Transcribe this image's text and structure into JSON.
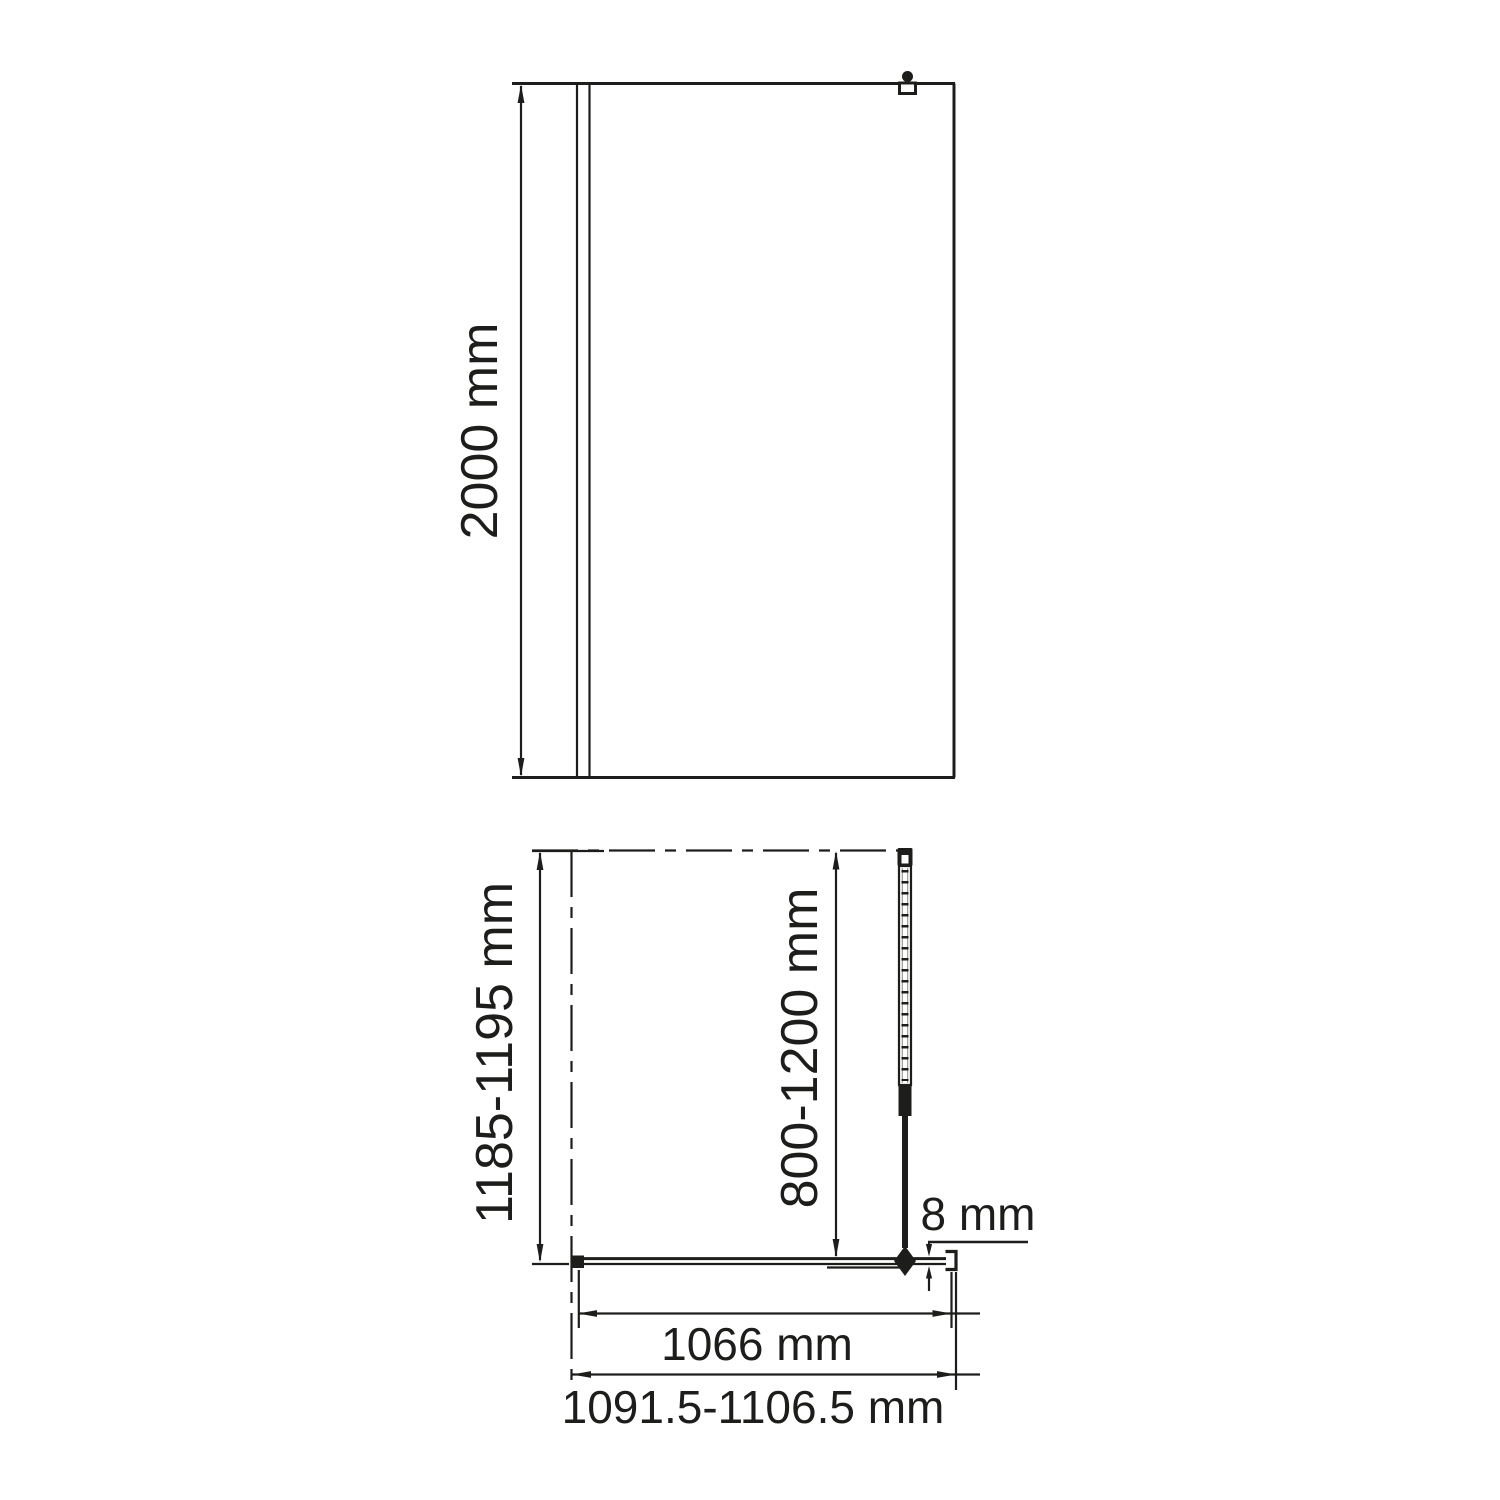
{
  "colors": {
    "background": "#ffffff",
    "line": "#1d1d1b"
  },
  "views": {
    "front": {
      "height_dim": "2000 mm"
    },
    "plan": {
      "depth_dim": "1185-1195 mm",
      "support_bar_dim": "800-1200 mm",
      "glass_thickness_dim": "8 mm",
      "glass_width_dim": "1066 mm",
      "overall_width_dim": "1091.5-1106.5 mm"
    }
  }
}
